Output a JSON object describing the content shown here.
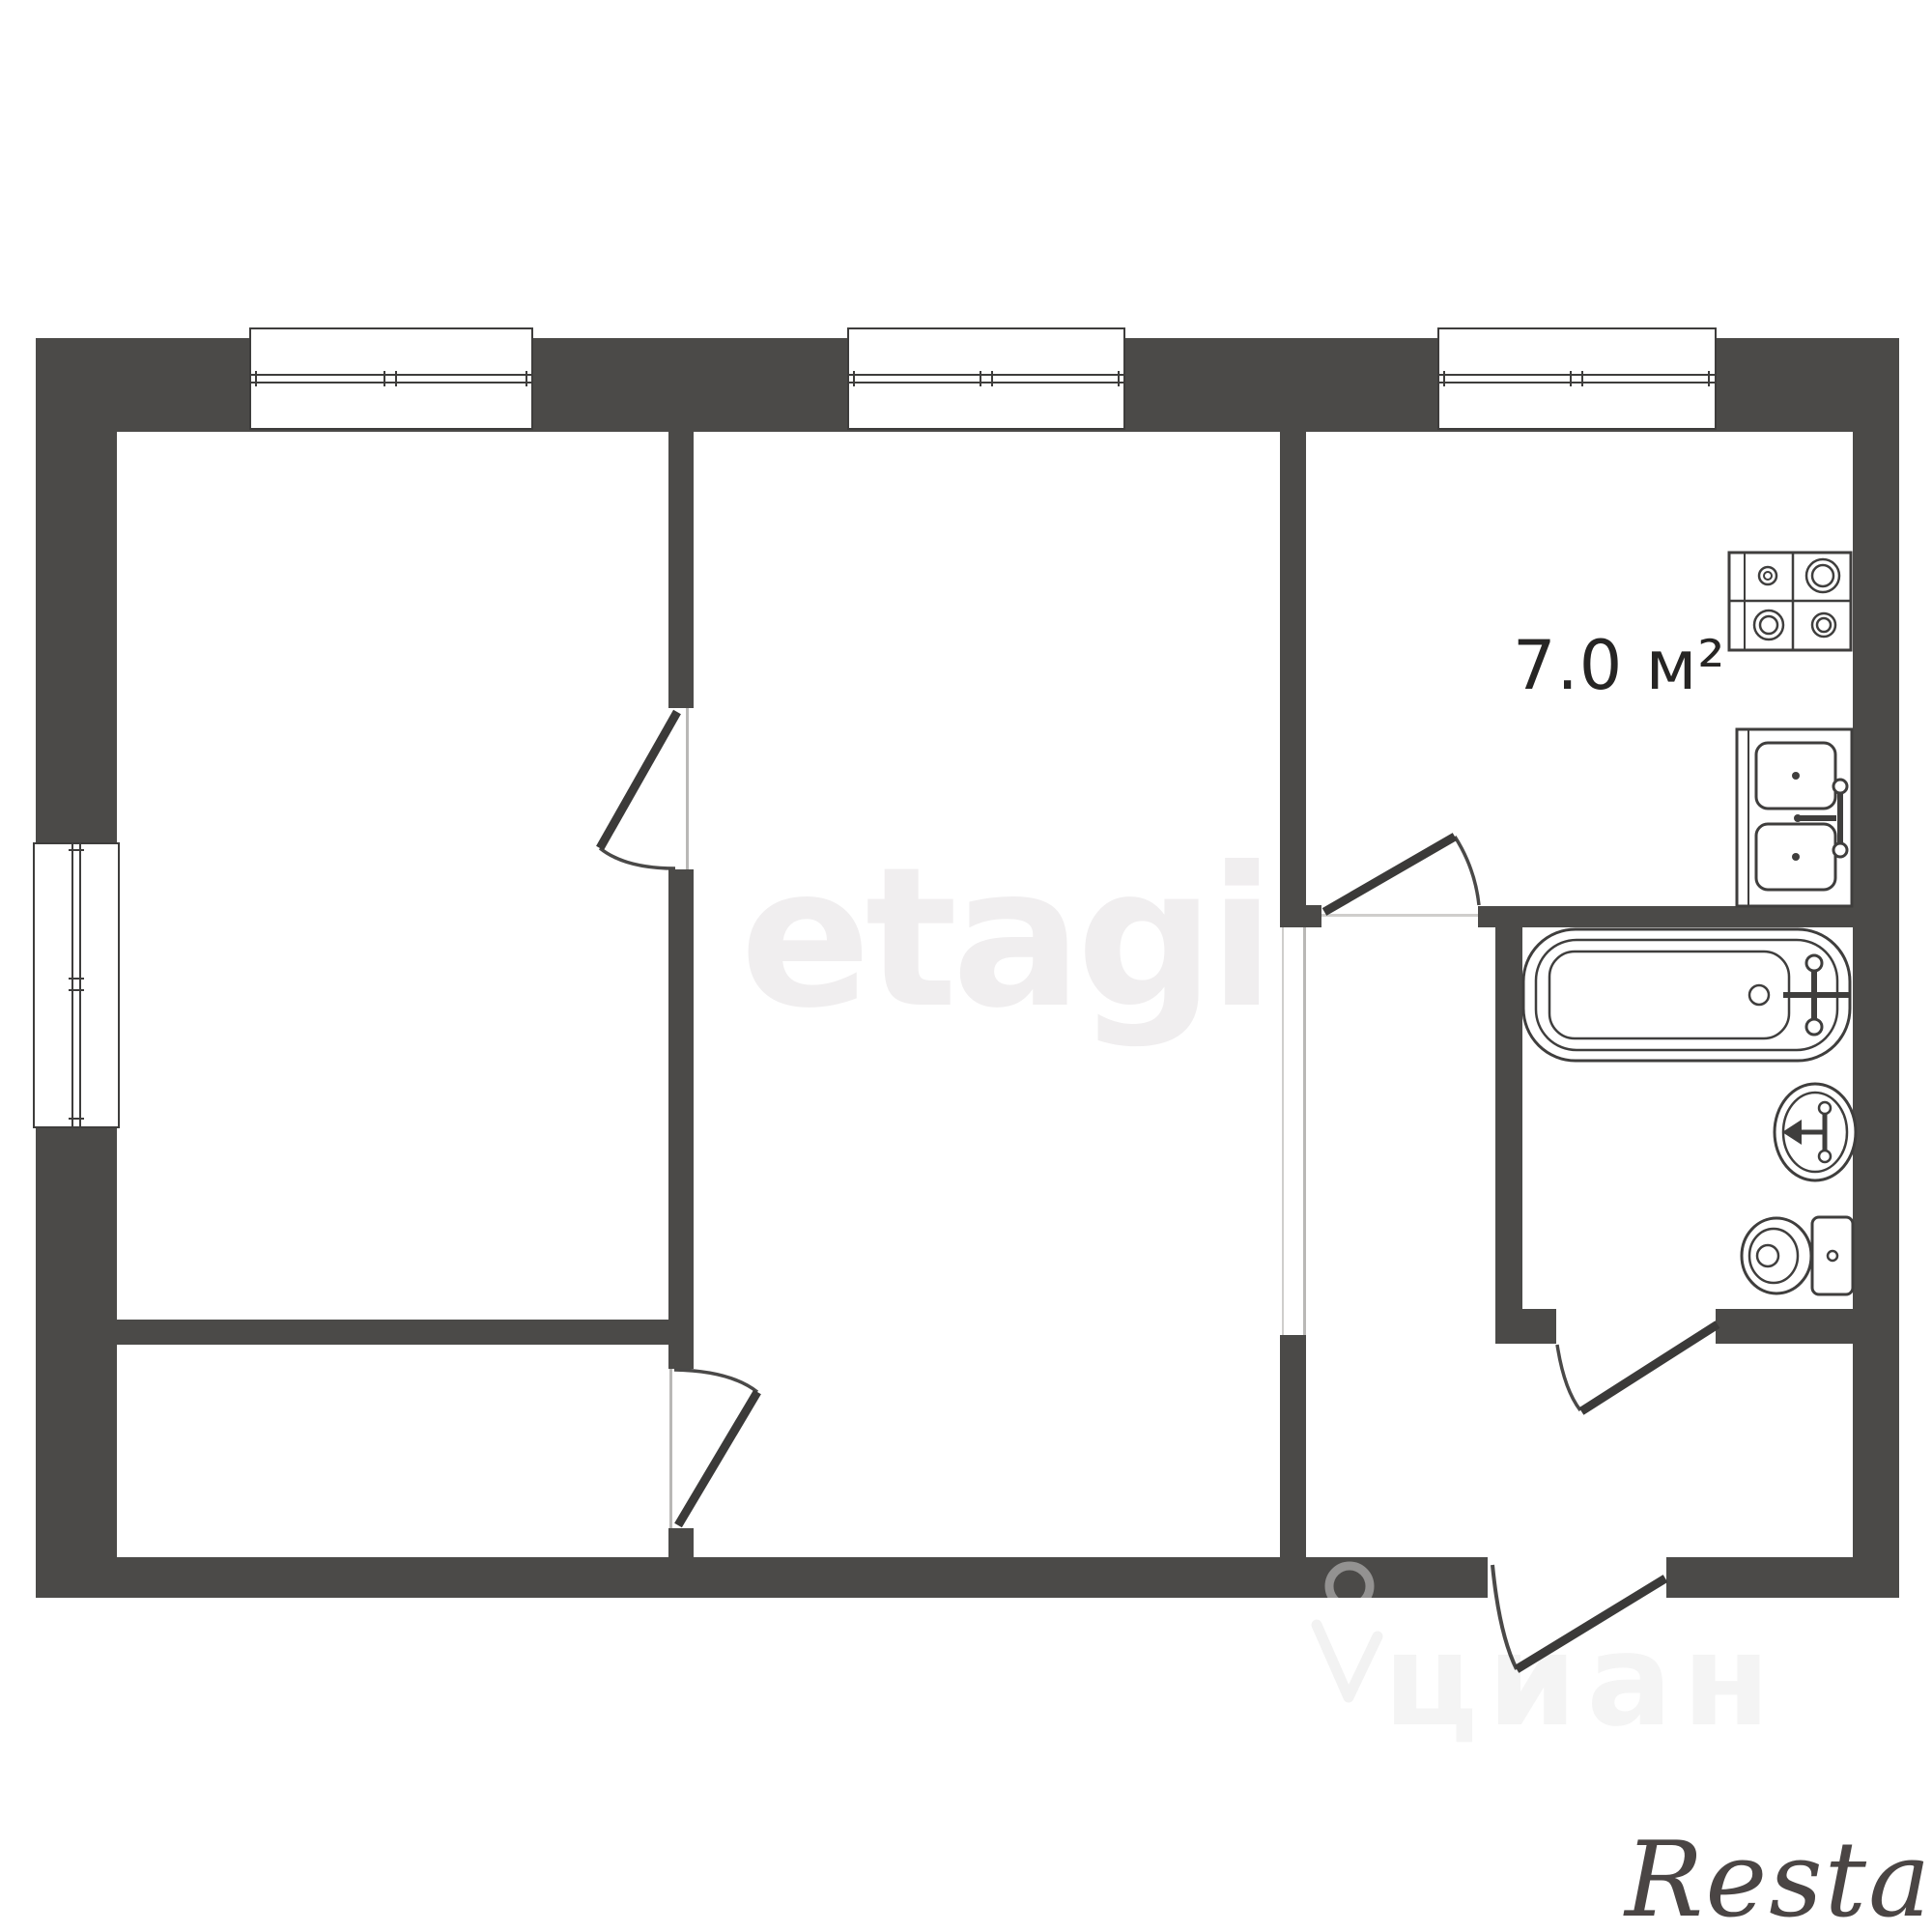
{
  "plan": {
    "type": "2-room apartment floor plan",
    "kitchen": {
      "area_label": "7.0 м²"
    },
    "rooms": [
      {
        "name": "room-left",
        "label": ""
      },
      {
        "name": "room-center",
        "label": ""
      },
      {
        "name": "kitchen",
        "label": "7.0 м²"
      },
      {
        "name": "bathroom",
        "label": ""
      },
      {
        "name": "hallway",
        "label": ""
      },
      {
        "name": "corridor-nook",
        "label": ""
      }
    ],
    "windows": [
      "top-window-left",
      "top-window-center",
      "top-window-right",
      "left-side-window"
    ],
    "doors": [
      "room-left-door",
      "corridor-to-room-center-door",
      "kitchen-door",
      "bathroom-door",
      "entrance-door",
      "room-center-hall-opening"
    ],
    "fixtures": [
      "stove",
      "kitchen-sink",
      "bathtub",
      "washbasin",
      "toilet"
    ],
    "colors": {
      "wall": "#4b4a48",
      "fixture_outline": "#3f3e3d",
      "area_label_text": "#262524",
      "background": "#ffffff"
    }
  },
  "watermarks": {
    "center_text": "etagi",
    "portal_text": "циан",
    "agency_text": "Restate",
    "colors": {
      "center": "#f0eeef",
      "portal": "rgba(62,61,59,0.055)",
      "agency": "#4a4544"
    }
  }
}
